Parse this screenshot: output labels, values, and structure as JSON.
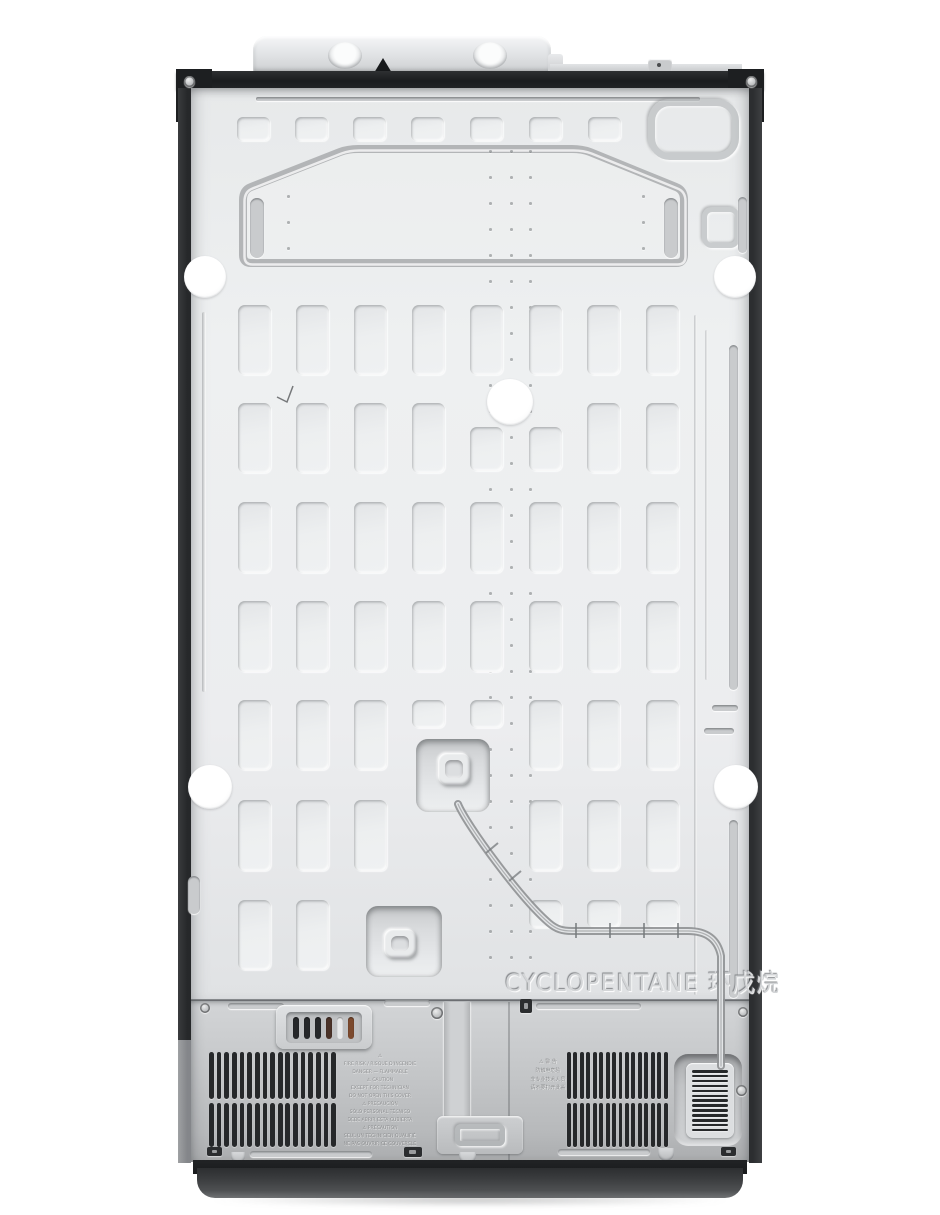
{
  "subject": "Rear view product photo of a side-by-side refrigerator back panel",
  "background_color": "#ffffff",
  "colors": {
    "panel_silver": "#ecedef",
    "panel_edge": "#d3d5d7",
    "compressor_plate": "#c6c8ca",
    "rail_black": "#1c1e20",
    "side_strip": "#2c2e30",
    "side_strip_lower_gray": "#8f9193",
    "vent_slat": "#26282a",
    "base_dark": "#3a3c3e",
    "shipping_pad_white": "#ffffff",
    "terminal_orange": "#7c4a2e"
  },
  "embossed": {
    "refrigerant": "CYCLOPENTANE 环戊烷"
  },
  "labels": {
    "left_warning_lines": [
      "⚠",
      "FIRE RISK / RISQUE D'INCENDIE",
      "DANGER — FLAMMABLE",
      "⚠ CAUTION",
      "EXCEPT FOR TECHNICIAN",
      "DO NOT OPEN THIS COVER",
      "⚠ PRECAUCIÓN",
      "SÓLO PERSONAL TÉCNICO",
      "DEBE ABRIR ESTA CUBIERTA",
      "⚠ PRÉCAUTION",
      "SEUL UN TECHNICIEN QUALIFIÉ",
      "NE PAS OUVRIR CE COUVERCLE"
    ],
    "right_warning_lines": [
      "⚠ 警 告",
      "防触电危险",
      "非专业技术人员",
      "请不要打开此盖"
    ]
  },
  "structure": {
    "emboss_grid": {
      "col_x": [
        238,
        296,
        354,
        412,
        470,
        529,
        587,
        646
      ],
      "cell_w": 33,
      "rows": [
        {
          "y": 305,
          "h": 70,
          "cols": [
            0,
            1,
            2,
            3,
            4,
            5,
            6,
            7
          ]
        },
        {
          "y": 403,
          "h": 70,
          "cols": [
            0,
            1,
            2,
            3,
            6,
            7
          ]
        },
        {
          "y": 427,
          "h": 44,
          "cols": [
            4,
            5
          ]
        },
        {
          "y": 502,
          "h": 71,
          "cols": [
            0,
            1,
            2,
            3,
            4,
            5,
            6,
            7
          ]
        },
        {
          "y": 601,
          "h": 71,
          "cols": [
            0,
            1,
            2,
            3,
            4,
            5,
            6,
            7
          ]
        },
        {
          "y": 700,
          "h": 70,
          "cols": [
            0,
            1,
            2,
            5,
            6,
            7
          ]
        },
        {
          "y": 700,
          "h": 28,
          "cols": [
            3,
            4
          ]
        },
        {
          "y": 800,
          "h": 71,
          "cols": [
            0,
            1,
            2,
            5,
            6,
            7
          ]
        },
        {
          "y": 900,
          "h": 70,
          "cols": [
            0,
            1
          ]
        },
        {
          "y": 900,
          "h": 28,
          "cols": [
            5,
            6,
            7
          ]
        }
      ]
    },
    "top_squares_row": {
      "x": [
        237,
        295,
        353,
        411,
        470,
        529,
        588
      ],
      "y": 117,
      "w": 33,
      "h": 24
    },
    "dot_columns": [
      {
        "x": 489,
        "y0": 150,
        "y1": 962,
        "step": 26
      },
      {
        "x": 510,
        "y0": 150,
        "y1": 962,
        "step": 26
      },
      {
        "x": 529,
        "y0": 150,
        "y1": 962,
        "step": 26
      },
      {
        "x": 287,
        "y0": 195,
        "y1": 248,
        "step": 26
      },
      {
        "x": 642,
        "y0": 195,
        "y1": 248,
        "step": 26
      }
    ],
    "shipping_pads": [
      {
        "x": 205,
        "y": 277,
        "r": 21
      },
      {
        "x": 735,
        "y": 277,
        "r": 21
      },
      {
        "x": 510,
        "y": 402,
        "r": 23
      },
      {
        "x": 210,
        "y": 787,
        "r": 22
      },
      {
        "x": 736,
        "y": 787,
        "r": 22
      }
    ],
    "vents": {
      "rows_y": [
        1052,
        1103
      ],
      "rows_h": [
        47,
        44
      ],
      "left": {
        "x": 209,
        "w": 130,
        "slats": 17
      },
      "right": {
        "x": 567,
        "w": 103,
        "slats": 16
      },
      "mini": {
        "x": 692,
        "y": 1070,
        "w": 36,
        "slats": 13,
        "pitch": 4.9,
        "slat_h": 2.6
      }
    },
    "terminal_slot_colors": [
      "#26282a",
      "#26282a",
      "#26282a",
      "#4a3228",
      "#e8e9ea",
      "#7c4a2e"
    ],
    "bottom_clips": [
      {
        "x": 207,
        "y": 1147,
        "w": 15,
        "h": 9
      },
      {
        "x": 404,
        "y": 1147,
        "w": 18,
        "h": 10
      },
      {
        "x": 721,
        "y": 1147,
        "w": 15,
        "h": 9
      }
    ],
    "screws": [
      {
        "x": 189,
        "y": 81,
        "r": 5.5
      },
      {
        "x": 751,
        "y": 81,
        "r": 5.5
      },
      {
        "x": 205,
        "y": 1008,
        "r": 5
      },
      {
        "x": 437,
        "y": 1013,
        "r": 6
      },
      {
        "x": 743,
        "y": 1012,
        "r": 5
      },
      {
        "x": 741,
        "y": 1090,
        "r": 5.5
      }
    ]
  }
}
